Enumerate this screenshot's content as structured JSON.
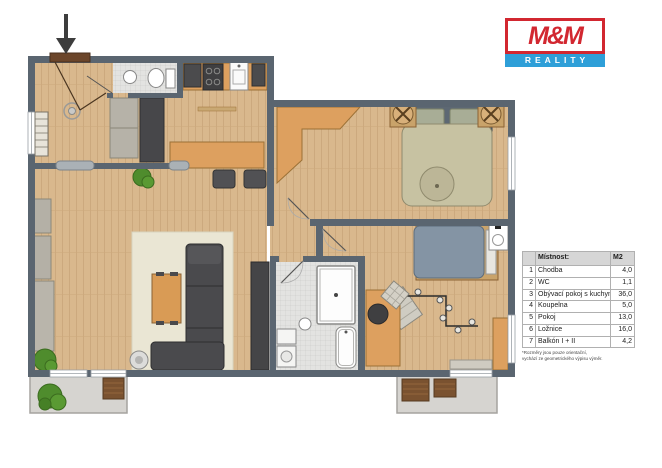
{
  "logo": {
    "name": "M&M",
    "tagline": "REALITY",
    "red": "#d22730",
    "blue": "#2e9fd8"
  },
  "legend": {
    "title": "Místnost:",
    "area_header": "M2",
    "rows": [
      {
        "num": "1",
        "name": "Chodba",
        "area": "4,0"
      },
      {
        "num": "2",
        "name": "WC",
        "area": "1,1"
      },
      {
        "num": "3",
        "name": "Obývací pokoj s kuchyní",
        "area": "36,0"
      },
      {
        "num": "4",
        "name": "Koupelna",
        "area": "5,0"
      },
      {
        "num": "5",
        "name": "Pokoj",
        "area": "13,0"
      },
      {
        "num": "6",
        "name": "Ložnice",
        "area": "16,0"
      },
      {
        "num": "7",
        "name": "Balkón I + II",
        "area": "4,2"
      }
    ],
    "footnote1": "*Rozměry jsou pouze orientační,",
    "footnote2": "vychází ze geometrického výpisu výměr."
  },
  "colors": {
    "wall": "#5a6570",
    "wood_floor": "#d9b88d",
    "tile_floor": "#e3e3e1",
    "balcony_floor": "#d6d4d0",
    "furniture_orange": "#dda05f",
    "furniture_dark": "#4a4a4d",
    "plant_green": "#4f8c2d"
  }
}
